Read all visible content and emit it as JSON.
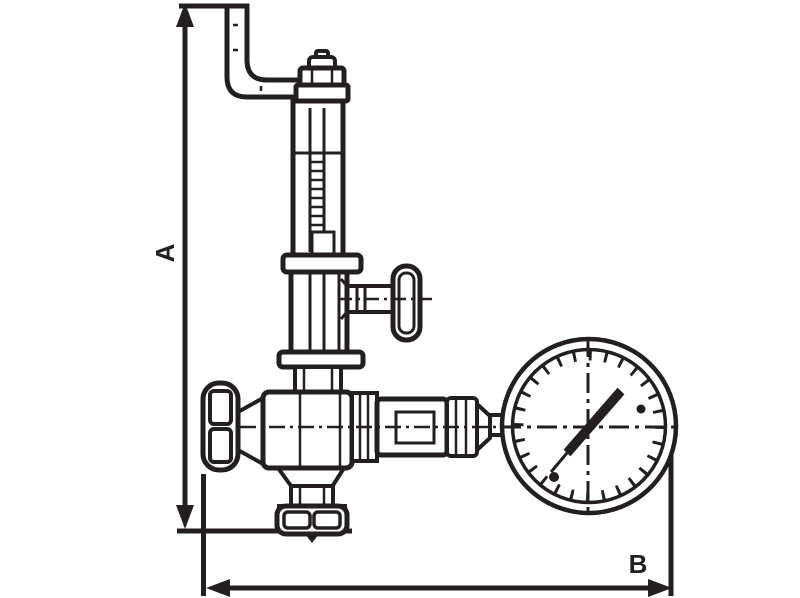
{
  "diagram": {
    "kind": "technical-dimension-drawing",
    "subject": "safety-relief-valve-with-pressure-gauge",
    "line_color": "#231f20",
    "background_color": "#ffffff",
    "labels": {
      "height_dimension": "A",
      "width_dimension": "B"
    },
    "components": [
      "bent-inlet-pipe",
      "adjustment-cap",
      "bonnet-tube",
      "threaded-stem",
      "spring-chamber",
      "t-handle",
      "handwheel",
      "valve-body",
      "outlet-fittings",
      "pressure-gauge",
      "bottom-outlet-flange",
      "dimension-line-a",
      "dimension-line-b"
    ]
  }
}
